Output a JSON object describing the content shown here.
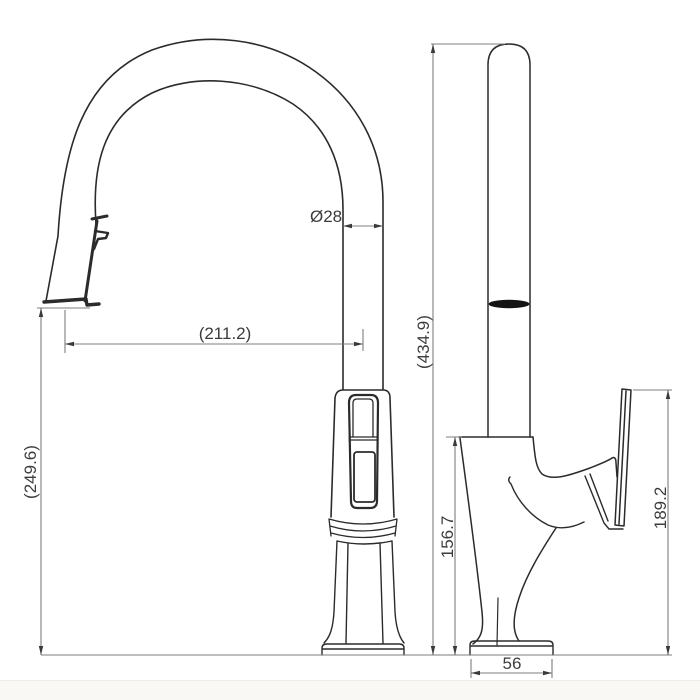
{
  "drawing": {
    "type": "faucet-technical-drawing",
    "views": {
      "front": "pull-down spout front view",
      "side": "side profile view"
    }
  },
  "dimensions": {
    "spout_diameter": "Ø28",
    "horizontal_reach": "(211.2)",
    "outlet_height": "(249.6)",
    "overall_height": "(434.9)",
    "body_height": "156.7",
    "handle_height": "189.2",
    "base_width": "56"
  },
  "colors": {
    "outline": "#2b2b2b",
    "dimension_line": "#7d7d7d",
    "dimension_text": "#3c3c3c",
    "seam_band": "#141414",
    "background": "#ffffff",
    "footer_strip": "#faf8f4"
  }
}
